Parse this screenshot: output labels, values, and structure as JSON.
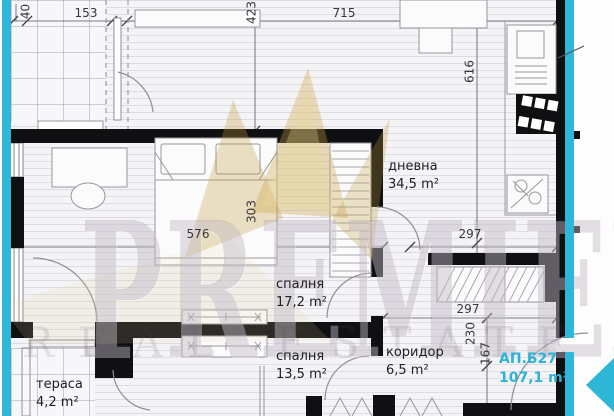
{
  "floor_plan": {
    "unit": {
      "id": "АП.Б27",
      "area": "107,1 m²"
    },
    "rooms": {
      "living": {
        "name": "дневна",
        "area": "34,5 m²"
      },
      "bedroom1": {
        "name": "спалня",
        "area": "17,2 m²"
      },
      "bedroom2": {
        "name": "спалня",
        "area": "13,5 m²"
      },
      "corridor": {
        "name": "коридор",
        "area": "6,5 m²"
      },
      "terrace": {
        "name": "тераса",
        "area": "4,2 m²"
      }
    },
    "dimensions_cm": {
      "d40": "40",
      "d153": "153",
      "d423": "423",
      "d715": "715",
      "d616": "616",
      "d303": "303",
      "d576": "576",
      "d297_top": "297",
      "d297_mid": "297",
      "d230": "230",
      "d167": "167"
    },
    "watermark": {
      "brand": "PREMIER",
      "tagline": "REAL ESTATE"
    },
    "colors": {
      "accent_cyan": "#2fb6d9",
      "wall_black": "#101013",
      "watermark_gold": "#c6a040"
    }
  }
}
